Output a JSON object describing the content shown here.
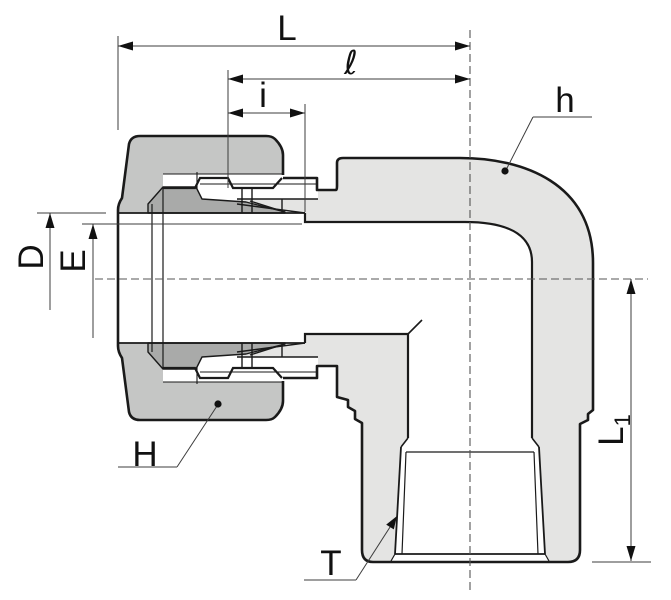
{
  "drawing": {
    "description": "Cross-section technical drawing of a 90-degree elbow compression tube fitting with female thread outlet",
    "labels": {
      "L": "L",
      "ell": "ℓ",
      "i": "i",
      "h": "h",
      "D": "D",
      "E": "E",
      "H": "H",
      "L1_base": "L",
      "L1_sub": "1",
      "T": "T"
    },
    "colors": {
      "background": "#ffffff",
      "body": "#e4e4e3",
      "nut": "#c5c6c5",
      "section_dark": "#a9aaa9",
      "outline": "#1a1a1a",
      "dimension": "#3c3c3c",
      "centerline": "#555555"
    }
  }
}
